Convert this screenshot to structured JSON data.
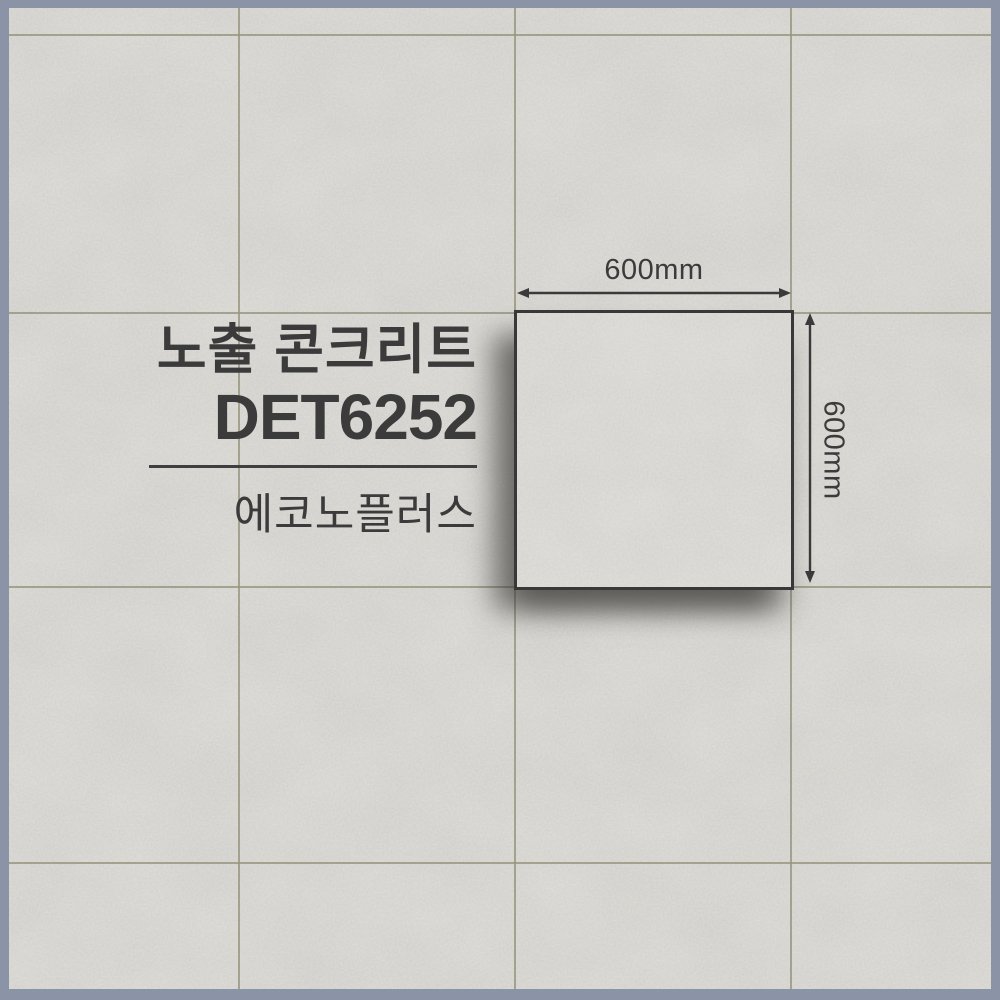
{
  "product": {
    "category_title": "노출 콘크리트",
    "code": "DET6252",
    "brand": "에코노플러스"
  },
  "dimensions": {
    "width_label": "600mm",
    "height_label": "600mm"
  },
  "material": {
    "surface": "concrete-texture-tile",
    "grid": "4x4 tiles"
  },
  "colors": {
    "frame": "#8b93a7",
    "tile_base": "#d5d3ce",
    "grout": "#97947e",
    "ink": "#3b3b3b"
  }
}
